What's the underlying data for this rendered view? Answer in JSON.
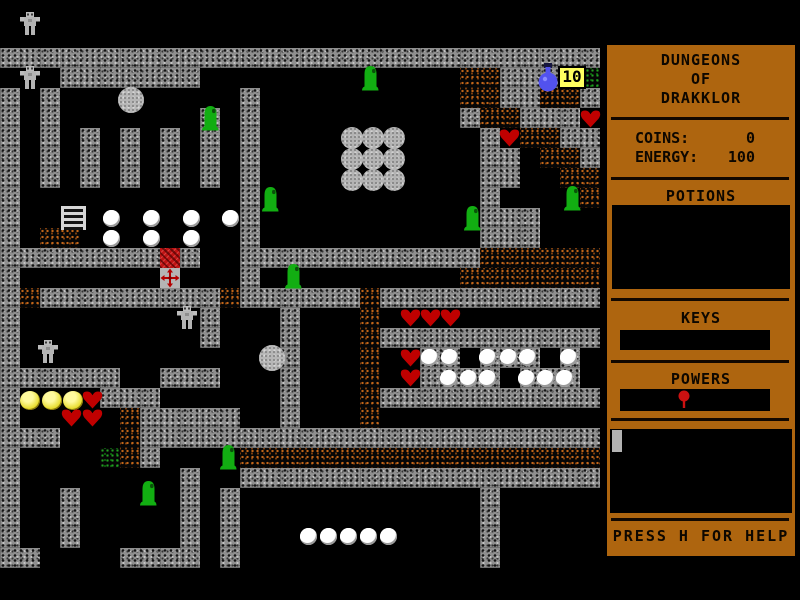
{
  "sidebar": {
    "title": {
      "line1": "DUNGEONS",
      "line2": "OF",
      "line3": "DRAKKLOR"
    },
    "stats": {
      "coins_label": "COINS:",
      "coins_value": "0",
      "energy_label": "ENERGY:",
      "energy_value": "100"
    },
    "sections": {
      "potions": "POTIONS",
      "keys": "KEYS",
      "powers": "POWERS"
    },
    "powers_items": [
      "red-pin"
    ],
    "help_text": "PRESS H FOR HELP"
  },
  "hud": {
    "potion_counter": "10"
  },
  "colors": {
    "panel_brown": "#ae650f",
    "wall_gray": "#8f8f8f",
    "rubble_orange": "#c2661a",
    "moss_green": "#22a022",
    "heart_red": "#c00000",
    "slime_green": "#12ae12",
    "coin_yellow": "#e8dd30",
    "potion_blue": "#5252ee",
    "label_yellow": "#ffff60"
  },
  "map": {
    "tile_size": 20,
    "origin_y": 48,
    "legend": {
      "W": "wall",
      ".": "floor",
      "R": "rubble",
      "G": "moss"
    },
    "tiles": [
      "WWWWWWWWWWWWWWWWWWWWWWWWWWWWWW",
      "...WWWWWWW.............RRWWWWG",
      "W.W.........W..........RRWWRRW",
      "W.W.......W.W..........WRRWWW.",
      "W.W.W.W.W.W.W...........W.RRWW",
      "W.W.W.W.W.W.W...........WW.RRW",
      "W.W.W.W.W.W.W...........WW..RR",
      "W...........W...........W....R",
      "W...........W...........WWW...",
      "W.RR........W...........WWW...",
      "WWWWWWWWWW..WWWWWWWWWWWWRRRRRR",
      "W.......W...W..........RRRRRRR",
      "WRWWWWWWWWWRWWWWWWRWWWWWWWWWWW",
      "W.........W...W...R...........",
      "W.........W...W...RWWWWWWWWWWW",
      "W.............W...R..WW.WWW.W.",
      "WWWWWW..WWW...W...R..WWWW.WWW.",
      "W....WWW......W...RWWWWWWWWWWW",
      "W.....RWWWWW..W...R...........",
      "WWW...RWWWWWWWWWWWWWWWWWWWWWWW",
      "W....GRW....RRRRRRRRRRRRRRRRRR",
      "W........W..WWWWWWWWWWWWWWWWWW",
      "W..W.....W.W............W.....",
      "W..W.....W.W............W.....",
      "W..W.....W.W............W.....",
      "WW....WWWW.W............W....."
    ]
  },
  "sprites": [
    {
      "type": "robot",
      "x": 20,
      "y": 12
    },
    {
      "type": "robot",
      "x": 20,
      "y": 66
    },
    {
      "type": "slime",
      "x": 360,
      "y": 64
    },
    {
      "type": "potion",
      "x": 536,
      "y": 63
    },
    {
      "type": "label10",
      "x": 558,
      "y": 66
    },
    {
      "type": "bigball",
      "x": 118,
      "y": 87
    },
    {
      "type": "slime",
      "x": 200,
      "y": 104
    },
    {
      "type": "heart",
      "x": 580,
      "y": 110
    },
    {
      "type": "heart",
      "x": 499,
      "y": 129
    },
    {
      "type": "boulder",
      "x": 341,
      "y": 127
    },
    {
      "type": "boulder",
      "x": 362,
      "y": 127
    },
    {
      "type": "boulder",
      "x": 383,
      "y": 127
    },
    {
      "type": "boulder",
      "x": 341,
      "y": 148
    },
    {
      "type": "boulder",
      "x": 362,
      "y": 148
    },
    {
      "type": "boulder",
      "x": 383,
      "y": 148
    },
    {
      "type": "boulder",
      "x": 341,
      "y": 169
    },
    {
      "type": "boulder",
      "x": 362,
      "y": 169
    },
    {
      "type": "boulder",
      "x": 383,
      "y": 169
    },
    {
      "type": "slime",
      "x": 260,
      "y": 185
    },
    {
      "type": "slime",
      "x": 562,
      "y": 184
    },
    {
      "type": "ladder",
      "x": 61,
      "y": 206
    },
    {
      "type": "slime",
      "x": 462,
      "y": 204
    },
    {
      "type": "orb",
      "x": 103,
      "y": 210
    },
    {
      "type": "orb",
      "x": 143,
      "y": 210
    },
    {
      "type": "orb",
      "x": 183,
      "y": 210
    },
    {
      "type": "orb",
      "x": 222,
      "y": 210
    },
    {
      "type": "orb",
      "x": 103,
      "y": 230
    },
    {
      "type": "orb",
      "x": 143,
      "y": 230
    },
    {
      "type": "orb",
      "x": 183,
      "y": 230
    },
    {
      "type": "chest",
      "x": 160,
      "y": 248
    },
    {
      "type": "cross",
      "x": 160,
      "y": 268
    },
    {
      "type": "slime",
      "x": 283,
      "y": 262
    },
    {
      "type": "robot",
      "x": 177,
      "y": 306
    },
    {
      "type": "heart",
      "x": 400,
      "y": 309
    },
    {
      "type": "heart",
      "x": 420,
      "y": 309
    },
    {
      "type": "heart",
      "x": 440,
      "y": 309
    },
    {
      "type": "bigball",
      "x": 259,
      "y": 345
    },
    {
      "type": "robot",
      "x": 38,
      "y": 340
    },
    {
      "type": "heart",
      "x": 400,
      "y": 349
    },
    {
      "type": "orb",
      "x": 421,
      "y": 349
    },
    {
      "type": "orb",
      "x": 441,
      "y": 349
    },
    {
      "type": "orb",
      "x": 479,
      "y": 349
    },
    {
      "type": "orb",
      "x": 500,
      "y": 349
    },
    {
      "type": "orb",
      "x": 519,
      "y": 349
    },
    {
      "type": "orb",
      "x": 560,
      "y": 349
    },
    {
      "type": "heart",
      "x": 400,
      "y": 369
    },
    {
      "type": "orb",
      "x": 440,
      "y": 370
    },
    {
      "type": "orb",
      "x": 460,
      "y": 370
    },
    {
      "type": "orb",
      "x": 479,
      "y": 370
    },
    {
      "type": "orb",
      "x": 518,
      "y": 370
    },
    {
      "type": "orb",
      "x": 537,
      "y": 370
    },
    {
      "type": "orb",
      "x": 556,
      "y": 370
    },
    {
      "type": "coin",
      "x": 20,
      "y": 391
    },
    {
      "type": "coin",
      "x": 42,
      "y": 391
    },
    {
      "type": "coin",
      "x": 63,
      "y": 391
    },
    {
      "type": "heart",
      "x": 82,
      "y": 391
    },
    {
      "type": "heart",
      "x": 61,
      "y": 409
    },
    {
      "type": "heart",
      "x": 82,
      "y": 409
    },
    {
      "type": "slime",
      "x": 218,
      "y": 443
    },
    {
      "type": "slime",
      "x": 138,
      "y": 479
    },
    {
      "type": "orb",
      "x": 300,
      "y": 528
    },
    {
      "type": "orb",
      "x": 320,
      "y": 528
    },
    {
      "type": "orb",
      "x": 340,
      "y": 528
    },
    {
      "type": "orb",
      "x": 360,
      "y": 528
    },
    {
      "type": "orb",
      "x": 380,
      "y": 528
    }
  ]
}
